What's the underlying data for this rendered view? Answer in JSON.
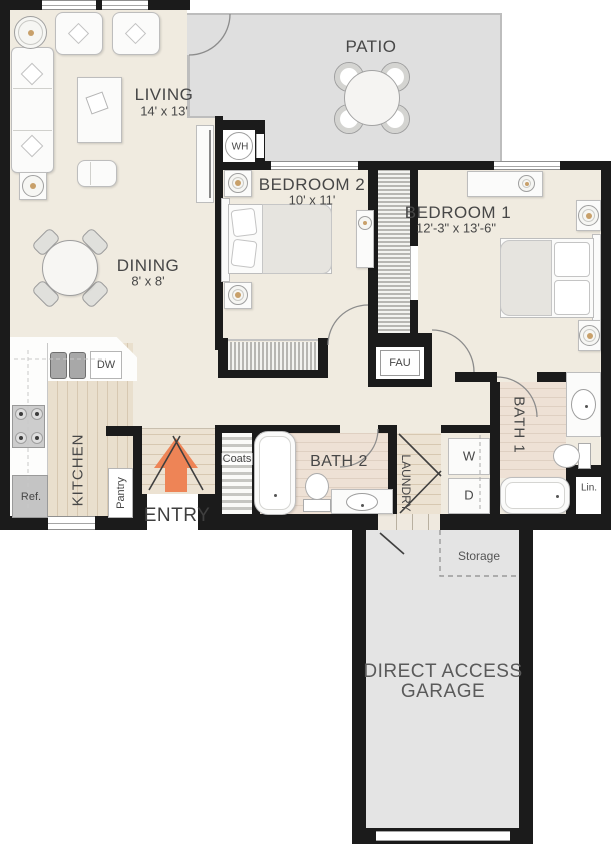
{
  "rooms": {
    "living": {
      "title": "LIVING",
      "dims": "14' x 13'"
    },
    "dining": {
      "title": "DINING",
      "dims": "8' x 8'"
    },
    "patio": {
      "title": "PATIO"
    },
    "bedroom2": {
      "title": "BEDROOM 2",
      "dims": "10' x 11'"
    },
    "bedroom1": {
      "title": "BEDROOM 1",
      "dims": "12'-3\" x 13'-6\""
    },
    "kitchen": {
      "title": "KITCHEN"
    },
    "bath2": {
      "title": "BATH 2"
    },
    "bath1": {
      "title": "BATH 1"
    },
    "laundry": {
      "title": "LAUNDRY"
    },
    "entry": {
      "title": "ENTRY"
    },
    "garage": {
      "line1": "DIRECT ACCESS",
      "line2": "GARAGE"
    },
    "storage": {
      "title": "Storage"
    }
  },
  "fixtures": {
    "water_heater": "WH",
    "dishwasher": "DW",
    "fau": "FAU",
    "refrigerator": "Ref.",
    "pantry": "Pantry",
    "coats": "Coats",
    "washer": "W",
    "dryer": "D",
    "linen": "Lin."
  },
  "colors": {
    "entry_arrow": "#ee8456",
    "walls": "#1b1b1b",
    "interior_floor": "#f0ebe0",
    "patio_floor": "#dfdfdf",
    "garage_floor": "#e4e4e4"
  }
}
